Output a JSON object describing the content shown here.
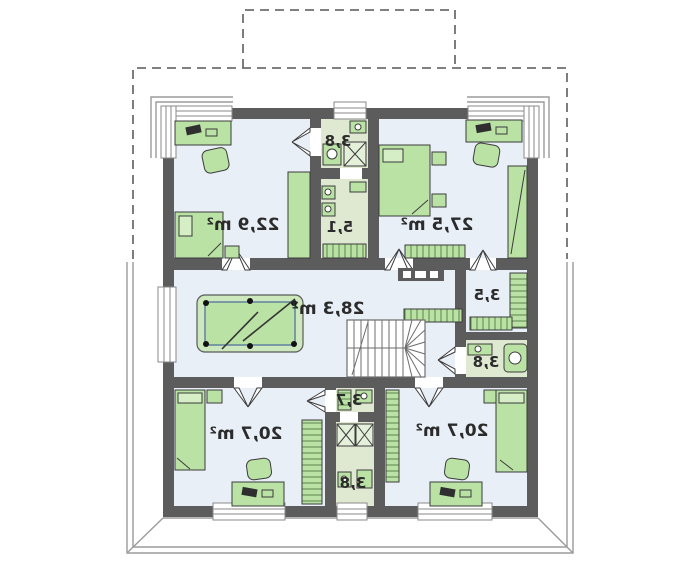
{
  "plan": {
    "type": "floor-plan",
    "orientation": "mirrored",
    "rooms": [
      {
        "name": "bedroom-top-left",
        "area_label": "22,9 m²"
      },
      {
        "name": "bathroom-top",
        "area_label": "3,8"
      },
      {
        "name": "laundry-top",
        "area_label": "5,1"
      },
      {
        "name": "bedroom-top-right",
        "area_label": "27,5 m²"
      },
      {
        "name": "hall-billiard-room",
        "area_label": "28,3 m²"
      },
      {
        "name": "wardrobe-right",
        "area_label": "3,5"
      },
      {
        "name": "bathroom-right",
        "area_label": "3,8"
      },
      {
        "name": "bedroom-bottom-left",
        "area_label": "20,7 m²"
      },
      {
        "name": "wardrobe-bottom",
        "area_label": "3,7"
      },
      {
        "name": "bathroom-bottom",
        "area_label": "3,8"
      },
      {
        "name": "bedroom-bottom-right",
        "area_label": "20,7 m²"
      }
    ],
    "colors": {
      "wall": "#5c5c5c",
      "room_floor": "#e9eff7",
      "wet_room_floor": "#dfe9d2",
      "furniture_green": "#b9e2a4",
      "roof_dashed_line": "#6f6f6f",
      "terrace_line": "#9b9b9b",
      "label_text": "#2b2b2b"
    }
  }
}
